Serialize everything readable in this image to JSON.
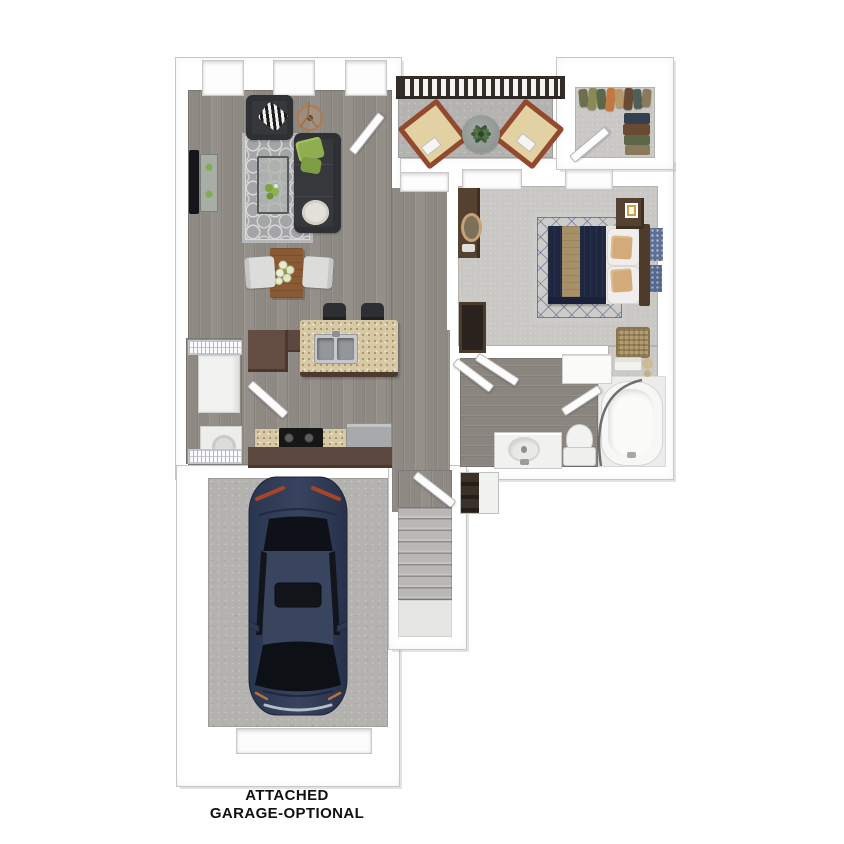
{
  "caption": {
    "line1": "ATTACHED",
    "line2": "GARAGE-OPTIONAL"
  },
  "palette": {
    "background": "#ffffff",
    "wall": "#ffffff",
    "wall_outline": "#c6c6c6",
    "wood_floor": "#8e8983",
    "carpet": "#c9c8c5",
    "concrete": "#b5b3b0",
    "sofa_charcoal": "#36383c",
    "pillow_green": "#8fae4f",
    "living_rug": "#a4a5a7",
    "dining_table_wood": "#8a5a33",
    "granite_counter": "#d7c9a4",
    "cabinet_brown": "#5d4840",
    "bed_navy": "#1f2740",
    "bed_tan_runner": "#a78f68",
    "bed_rug_lattice": "#5f7086",
    "balcony_chair_wood": "#93492e",
    "balcony_cushion": "#e2d1a2",
    "railing_dark": "#332d27",
    "car_blue": "#2d3852",
    "stair_carpet": "#b3b1ae",
    "caption_text": "#111111"
  },
  "rooms": {
    "living_room": {
      "name": "living room",
      "furniture": [
        "sofa",
        "armchair",
        "zebra-pillow",
        "green-pillows",
        "coffee-table",
        "quatrefoil-rug",
        "wall-tv",
        "media-console",
        "floor-lamp",
        "dining-table",
        "dining-chairs",
        "three-windows"
      ]
    },
    "balcony": {
      "name": "balcony",
      "furniture": [
        "railing",
        "lounge-chair-left",
        "lounge-chair-right",
        "round-table",
        "potted-plant"
      ]
    },
    "walk_in_closet": {
      "name": "walk-in closet",
      "furniture": [
        "hanging-clothes",
        "folded-clothes",
        "door"
      ]
    },
    "bedroom": {
      "name": "bedroom",
      "furniture": [
        "queen-bed",
        "navy-comforter",
        "tan-runner",
        "accent-pillows",
        "headboard",
        "nightstand",
        "picture-frame",
        "dresser",
        "oval-mirror",
        "wardrobe",
        "lattice-rug",
        "laundry-basket",
        "wall-art",
        "two-windows"
      ]
    },
    "kitchen": {
      "name": "kitchen",
      "furniture": [
        "granite-island",
        "double-sink",
        "bar-stools",
        "l-cabinet",
        "counter",
        "stove",
        "refrigerator",
        "base-cabinets"
      ]
    },
    "laundry_closet": {
      "name": "laundry closet",
      "furniture": [
        "wire-shelves",
        "cabinet",
        "washer-dryer"
      ]
    },
    "bathroom": {
      "name": "bathroom",
      "furniture": [
        "vanity-sink",
        "toilet",
        "bathtub",
        "shower-curtain",
        "linen-closet",
        "towels",
        "candles"
      ]
    },
    "hallway": {
      "name": "hallway",
      "furniture": [
        "coat-closet-with-shoes",
        "entry-door",
        "interior-doors"
      ]
    },
    "stairwell": {
      "name": "stairwell",
      "furniture": [
        "stairs",
        "landing"
      ]
    },
    "garage": {
      "name": "attached garage",
      "furniture": [
        "blue-car",
        "garage-door"
      ]
    }
  }
}
